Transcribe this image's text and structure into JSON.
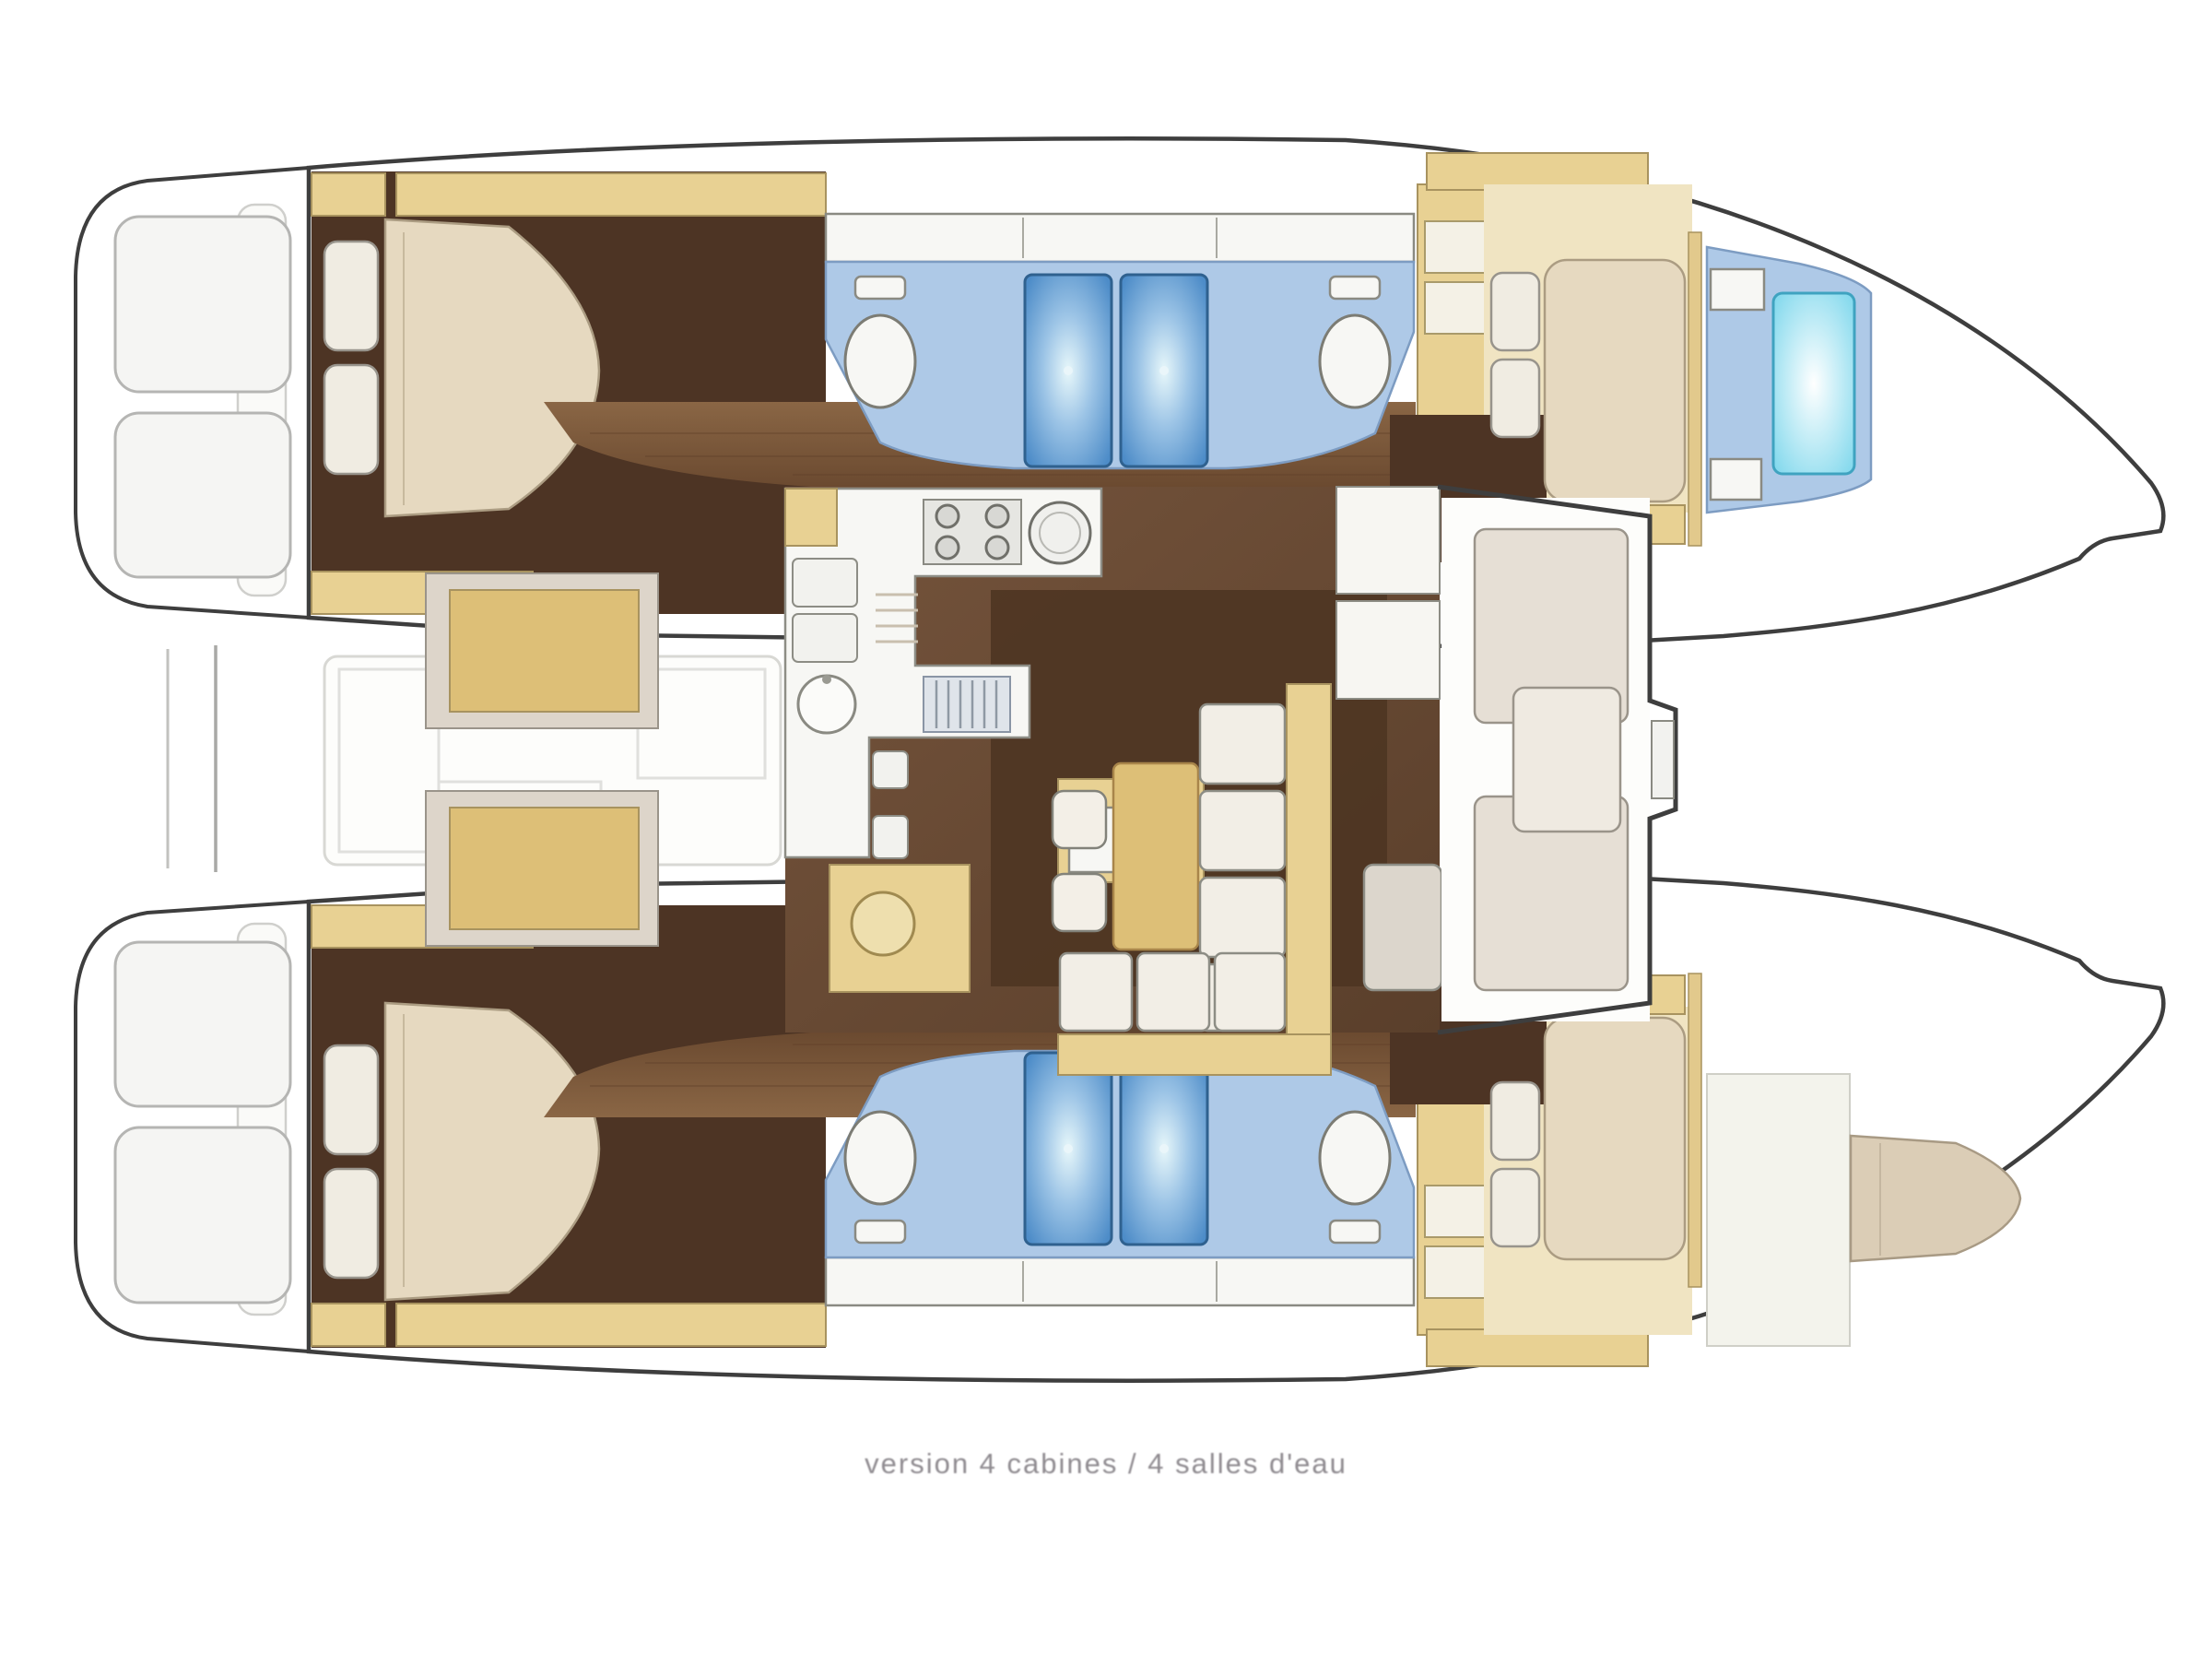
{
  "caption": {
    "text": "version 4 cabines / 4 salles d'eau"
  },
  "colors": {
    "floor_dark": "#4d3424",
    "wood_light": "#8a6645",
    "wood_dark": "#6b4a30",
    "salon_light": "#75543c",
    "salon_dark": "#5a3f2b",
    "patch_brown": "#4e3522",
    "cab_yellow": "#e8d193",
    "cab_yellow_deep": "#ddbf77",
    "floor_pale": "#f0e4c2",
    "bed_cream": "#e6d9c0",
    "pillow_white": "#f0ece2",
    "panel_grey": "#ddd5ca",
    "bath_blue": "#aec9e7",
    "shower_blue": "#4d8cc8",
    "shower_glow": "#e7f7fa",
    "shower_cyan": "#7dd7ec",
    "fixture_white": "#f7f7f4",
    "hull_stroke": "#3e3e3e",
    "faint_grey": "#d8d8d4",
    "berth_tan": "#dbcdb6",
    "seat_greige": "#e6dfd5",
    "caption_grey": "#8f8b90"
  }
}
